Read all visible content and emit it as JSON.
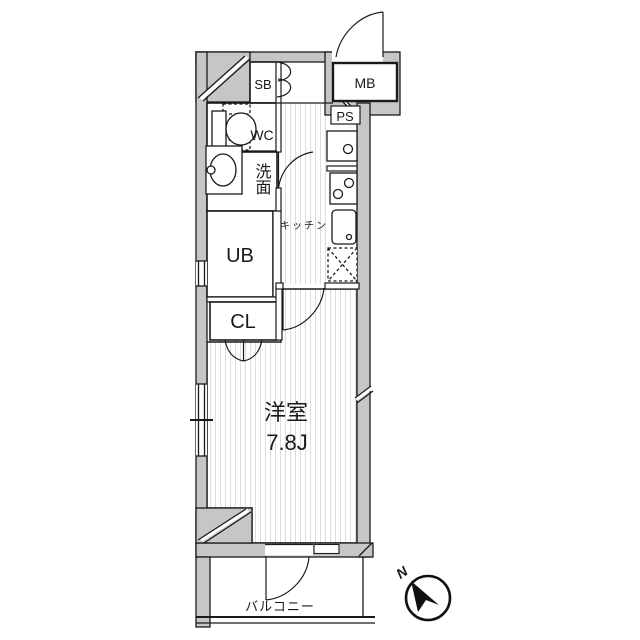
{
  "floorplan": {
    "compartments": {
      "shoe_box": "SB",
      "meter_box": "MB",
      "pipe_space": "PS",
      "toilet": "WC",
      "washroom": "洗面",
      "unit_bath": "UB",
      "closet": "CL",
      "kitchen": "キッチン",
      "balcony": "バルコニー"
    },
    "main_room": {
      "name": "洋室",
      "size": "7.8J"
    },
    "compass": {
      "north_label": "N"
    },
    "colors": {
      "wall": "#c6c6c6",
      "line": "#1a1a1a",
      "floor_stripe": "#dddddd"
    }
  }
}
